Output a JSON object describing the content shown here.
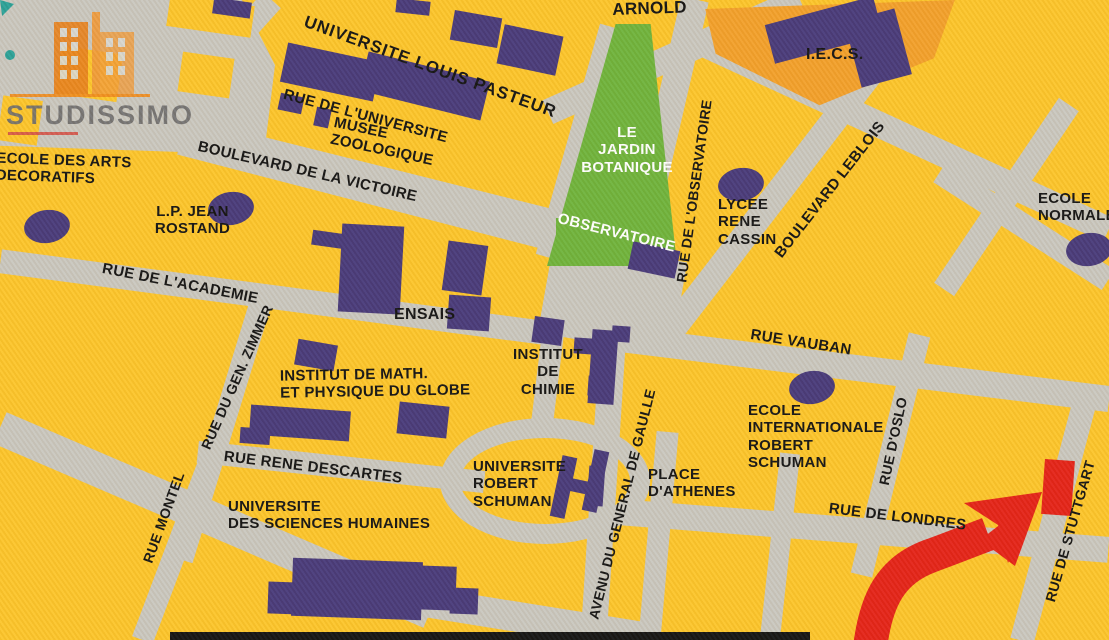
{
  "logo": {
    "brand": "STUDISSIMO"
  },
  "streets": {
    "arnold": "ARNOLD",
    "rue_universite": "RUE DE L'UNIVERSITE",
    "bd_victoire": "BOULEVARD DE LA VICTOIRE",
    "rue_academie": "RUE DE L'ACADEMIE",
    "rue_zimmer": "RUE DU GEN. ZIMMER",
    "rue_montel": "RUE MONTEL",
    "rue_descartes": "RUE RENE DESCARTES",
    "av_gaulle": "AVENU DU GENERAL DE GAULLE",
    "rue_observatoire": "RUE DE L'OBSERVATOIRE",
    "bd_leblois": "BOULEVARD LEBLOIS",
    "rue_vauban": "RUE VAUBAN",
    "rue_oslo": "RUE D'OSLO",
    "rue_londres": "RUE DE LONDRES",
    "rue_stuttgart": "RUE DE STUTTGART"
  },
  "places": {
    "univ_louis_pasteur": "UNIVERSITE LOUIS PASTEUR",
    "musee_zoologique": "MUSEE\nZOOLOGIQUE",
    "ecole_arts": "ECOLE DES ARTS\nDECORATIFS",
    "lp_jean_rostand": "L.P. JEAN\nROSTAND",
    "ensais": "ENSAIS",
    "institut_math": "INSTITUT  DE MATH.\nET PHYSIQUE DU GLOBE",
    "univ_sciences": "UNIVERSITE\nDES SCIENCES HUMAINES",
    "institut_chimie": "INSTITUT\nDE\nCHIMIE",
    "univ_robert_schuman": "UNIVERSITE\nROBERT\nSCHUMAN",
    "place_athenes": "PLACE\nD'ATHENES",
    "jardin_botanique": "LE\nJARDIN\nBOTANIQUE",
    "observatoire": "OBSERVATOIRE",
    "lycee_cassin": "LYCEE\nRENE\nCASSIN",
    "iecs": "I.E.C.S.",
    "ecole_internationale": "ECOLE\nINTERNATIONALE\nROBERT\nSCHUMAN",
    "ecole_normale": "ECOLE\nNORMALE"
  },
  "colors": {
    "block_yellow": "#fcc52b",
    "street_gray": "#c9c7bf",
    "building_purple": "#483a7a",
    "park_green": "#6fb33c",
    "iecs_orange": "#f2a02b",
    "arrow_red": "#e42318",
    "teal_accent": "#2aa198",
    "logo_gray": "#6e6e6e",
    "logo_orange": "#ef8c1e"
  }
}
